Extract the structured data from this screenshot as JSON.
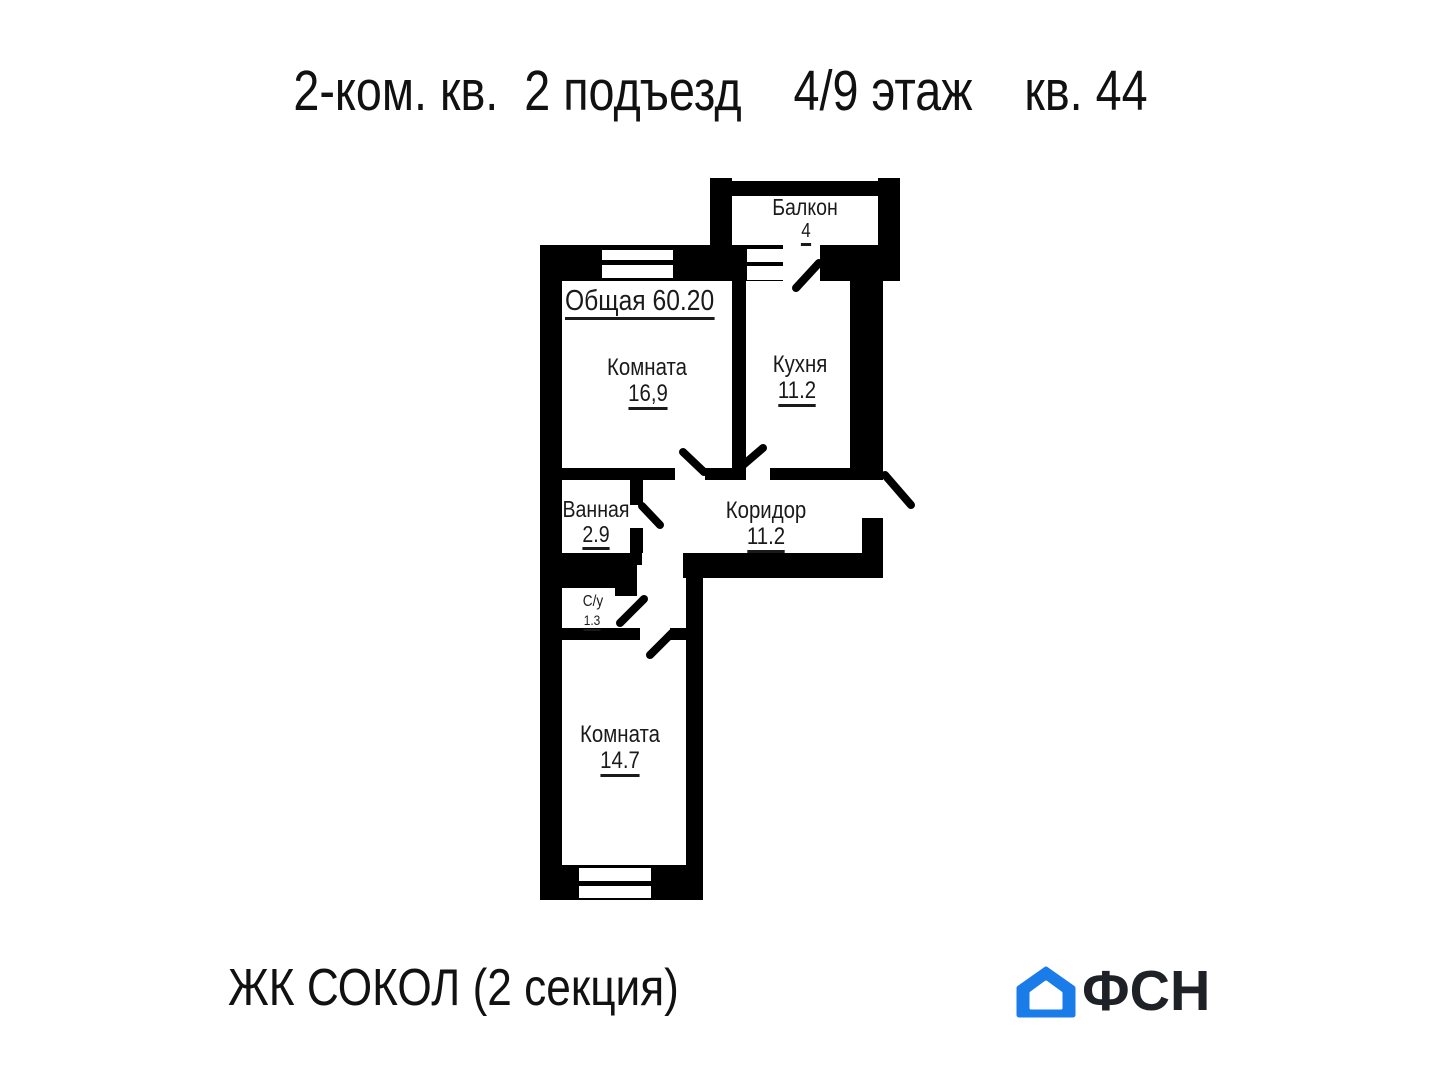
{
  "header": {
    "title": "2-ком. кв.  2 подъезд    4/9 этаж    кв. 44"
  },
  "plan": {
    "total_label": "Общая 60.20",
    "rooms": [
      {
        "name": "Балкон",
        "area": "4"
      },
      {
        "name": "Комната",
        "area": "16,9"
      },
      {
        "name": "Кухня",
        "area": "11.2"
      },
      {
        "name": "Ванная",
        "area": "2.9"
      },
      {
        "name": "Коридор",
        "area": "11.2"
      },
      {
        "name": "С/у",
        "area": "1.3"
      },
      {
        "name": "Комната",
        "area": "14.7"
      }
    ]
  },
  "footer": {
    "complex": "ЖК СОКОЛ (2 секция)",
    "brand": "ФСН",
    "brand_icon": "house-icon"
  },
  "colors": {
    "wall": "#000000",
    "text": "#1a1a1a",
    "brand_blue": "#1a7ce8",
    "brand_text": "#1e2126"
  }
}
